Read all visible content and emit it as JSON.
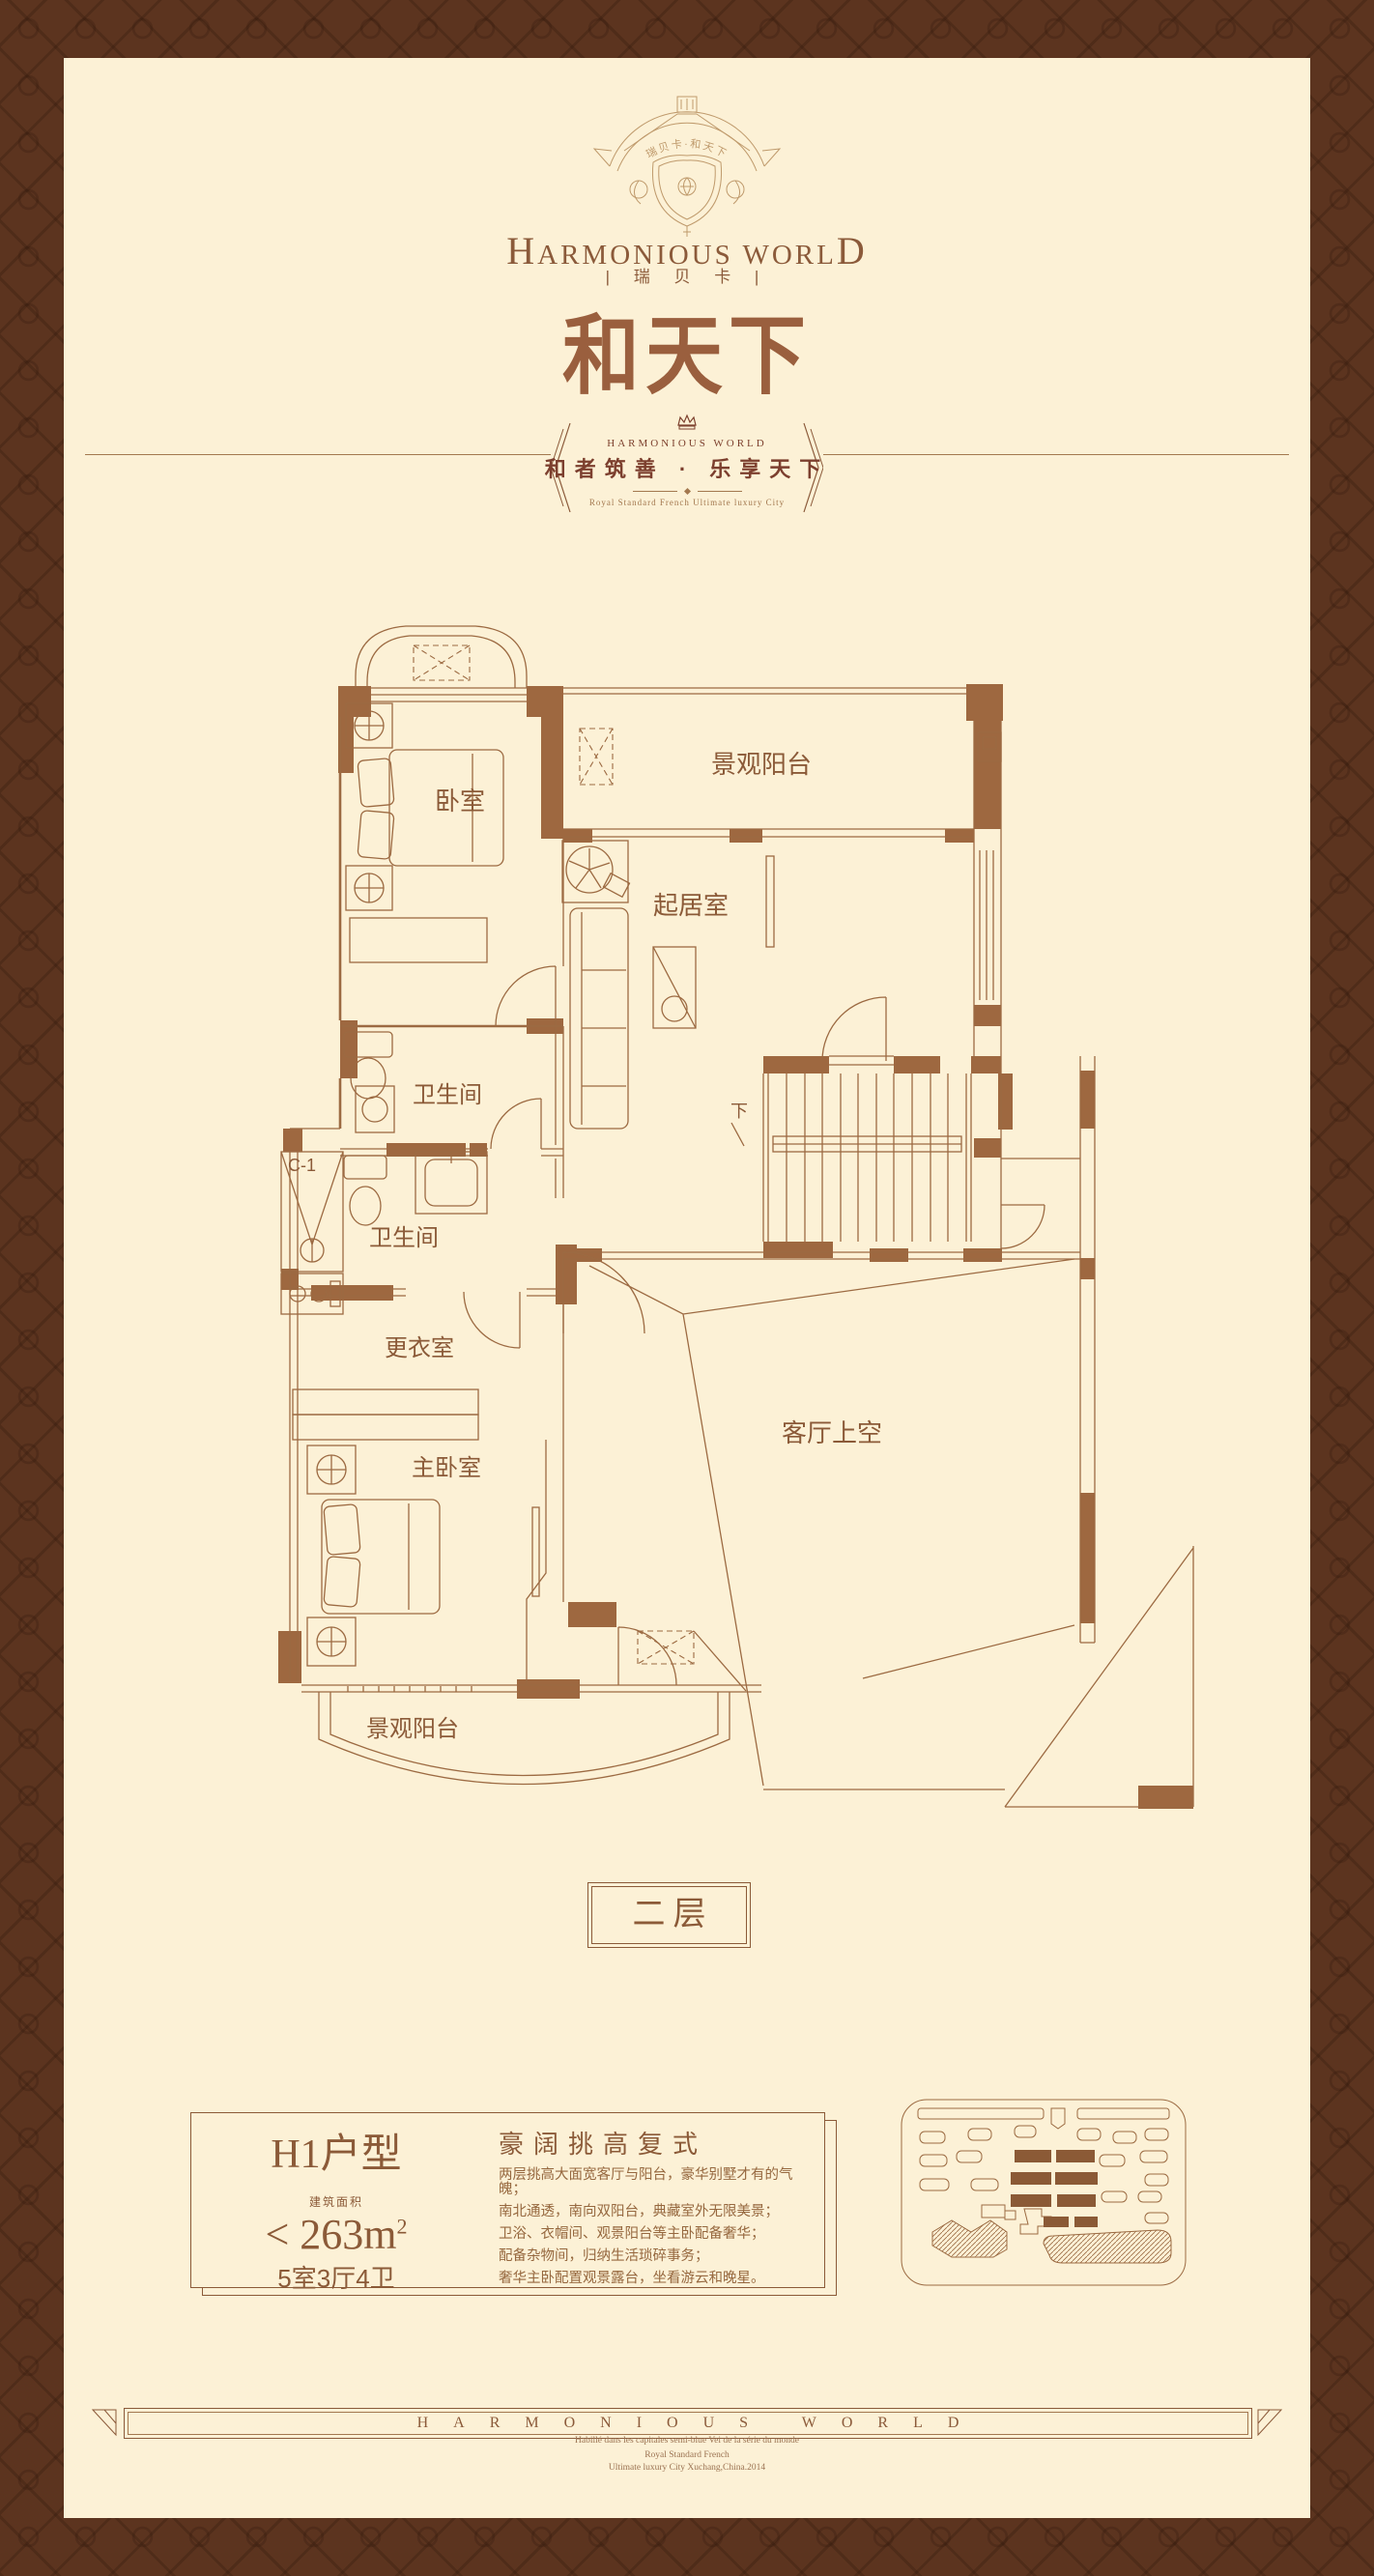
{
  "colors": {
    "border": "#5c341f",
    "panel": "#fcf1d6",
    "accent": "#9a5f3e",
    "line": "#9c6a42",
    "wall": "#9e6840",
    "text": "#8b5a38",
    "tagline": "#7c3f2e",
    "muted": "#a3784f"
  },
  "header": {
    "crest_banner": "瑞贝卡·和天下",
    "brand_first": "H",
    "brand_mid": "ARMONIOUS WORL",
    "brand_last": "D",
    "brand_sub": "| 瑞 贝 卡 |",
    "title": "和天下",
    "slogan_brand": "HARMONIOUS WORLD",
    "slogan": "和者筑善 · 乐享天下",
    "slogan_sub": "Royal Standard French Ultimate luxury City"
  },
  "plan": {
    "rooms": {
      "bedroom": "卧室",
      "balcony_top": "景观阳台",
      "living": "起居室",
      "bath_upper": "卫生间",
      "bath_lower": "卫生间",
      "dressing": "更衣室",
      "master": "主卧室",
      "void": "客厅上空",
      "balcony_bottom": "景观阳台"
    },
    "window_code": "C-1",
    "stairs_down": "下",
    "floor_badge": "二层"
  },
  "info": {
    "unit_name": "H1户型",
    "area_label": "建筑面积",
    "area_prefix": "<",
    "area_value": "263",
    "area_unit": "m",
    "area_power": "2",
    "layout_summary": "5室3厅4卫",
    "desc_title": "豪阔挑高复式",
    "desc_lines": [
      "两层挑高大面宽客厅与阳台，豪华别墅才有的气魄；",
      "南北通透，南向双阳台，典藏室外无限美景；",
      "卫浴、衣帽间、观景阳台等主卧配备奢华；",
      "配备杂物间，归纳生活琐碎事务；",
      "奢华主卧配置观景露台，坐看游云和晚星。"
    ]
  },
  "footer": {
    "banner": "HARMONIOUS WORLD",
    "line1": "Habillé dans les capitales semi-blue Vei de la série du monde",
    "line2": "Royal Standard French",
    "line3": "Ultimate luxury City Xuchang,China.2014"
  }
}
